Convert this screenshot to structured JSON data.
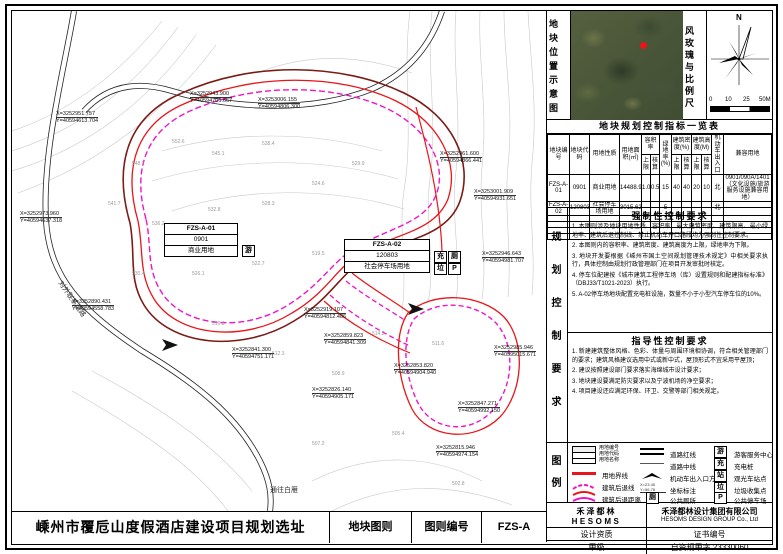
{
  "colors": {
    "boundary_red": "#e8151a",
    "setback_magenta": "#f013c8",
    "ring_maroon": "#7a1b15",
    "contour_gray": "#c9c9c9"
  },
  "titlebar": {
    "project": "嵊州市覆卮山度假酒店建设项目规划选址",
    "sheet_type": "地块图则",
    "sheet_no_label": "图则编号",
    "sheet_no": "FZS-A"
  },
  "panel": {
    "location_label": "地块位置示意图",
    "windrose_label": "风玫瑰与比例尺",
    "north": "N",
    "scale_ticks": [
      "0",
      "10",
      "25",
      "50M"
    ],
    "table": {
      "title": "地块规划控制指标一览表",
      "h1": {
        "plot_no": "地块编号",
        "plot_code": "地块代码",
        "land_use": "用地性质",
        "area": "用地面积(㎡)",
        "far": "容积率",
        "green": "绿地率(%)",
        "density": "建筑密度(%)",
        "height": "建筑高度(M)",
        "entrance": "机动车出入口",
        "compat": "兼容用地"
      },
      "h2": {
        "upper": "上限",
        "check": "核算"
      },
      "rows": [
        [
          "FZS-A-01",
          "0901",
          "商业用地",
          "14488.90",
          "1.0",
          "0.5",
          "15",
          "40",
          "40",
          "20",
          "10",
          "北",
          "0901/090A/1401（文化设施/旅游服务设施兼容用地）"
        ],
        [
          "FZS-A-02",
          "120803",
          "社会停车场用地",
          "3015.62",
          "-",
          "-",
          "5",
          "-",
          "-",
          "-",
          "-",
          "北",
          "-"
        ]
      ]
    },
    "side_label": "规划控制要求",
    "mandatory": {
      "title": "强制性控制要求",
      "items": [
        "1. 本图则涉及地块用地性质、容积率、最大建筑密度、建筑限高、最小绿地率、建筑后退控制线、禁止机动车开口路段均为强制性控制要求。",
        "2. 本图则内的容积率、建筑密度、建筑高度为上限，绿地率为下限。",
        "3. 地块开发要根据《嵊州市国土空间规划管理技术规定》中相关要求执行，具体控制由规划行政管理部门在项目开发审批时核定。",
        "4. 停车位配建按《城市建筑工程停车场（库）设置规则和配建指标标准》（DBJ33/T1021-2023）执行。",
        "5. A-02停车场地块配置充电桩设施，数量不小于小型汽车停车位的10%。"
      ]
    },
    "guiding": {
      "title": "指导性控制要求",
      "items": [
        "1. 新建建筑整体风格、色彩、体量与周围环境相协调，符合相关管理部门的要求；建筑风格建议选用中式或新中式，屋顶形式不宜采用平屋顶；",
        "2. 建议按照建设部门要求落实海绵城市设计要求；",
        "3. 地块建设要满足防灾要求以及宁波机场的净空要求；",
        "4. 项目建设还应满足环保、环卫、交警等部门相关规定。"
      ]
    },
    "legend": {
      "title": "图例",
      "sample_labels": [
        "用地编号",
        "用地代码",
        "用地名称"
      ],
      "col1": [
        "用地界线",
        "建筑后退线",
        "建筑后退距离"
      ],
      "col2": [
        "道路红线",
        "道路中线",
        "机动车出入口方位",
        "坐标标注",
        "公共厕所"
      ],
      "col2_toilet_icon": "厕",
      "coord_sample": "X=23.45 Y=56.78",
      "col3_icons": [
        "游",
        "充",
        "站",
        "垃",
        "P"
      ],
      "col3_labels": [
        "游客服务中心",
        "充电桩",
        "观光车站点",
        "垃圾收集点",
        "公共停车场"
      ]
    },
    "firm": {
      "logo_cn": "禾泽都林",
      "logo_en": "HESOMS",
      "name_cn": "禾泽都林设计集团有限公司",
      "name_en": "HESOMS DESIGN GROUP Co., Ltd",
      "qual_label": "设计资质",
      "cert_label": "证书编号",
      "qual_value": "甲级",
      "cert_value": "自资规甲字 23330060"
    }
  },
  "map": {
    "plots": [
      {
        "code": "FZS-A-01",
        "land_code": "0901",
        "land_use": "商业用地",
        "icons": [
          "游"
        ]
      },
      {
        "code": "FZS-A-02",
        "land_code": "120803",
        "land_use": "社会停车场用地",
        "icons": [
          "充",
          "厕",
          "垃",
          "P"
        ]
      }
    ],
    "road_label": "对外联系道路",
    "road_label2": "通往白雁",
    "coords": [
      {
        "x": 178,
        "y": 80,
        "l1": "X=3252943.900",
        "l2": "Y=40594706.667"
      },
      {
        "x": 44,
        "y": 100,
        "l1": "X=3252951.757",
        "l2": "Y=40594613.704"
      },
      {
        "x": 246,
        "y": 86,
        "l1": "X=3253006.155",
        "l2": "Y=40594806.300"
      },
      {
        "x": 8,
        "y": 200,
        "l1": "X=3252973.960",
        "l2": "Y=40594637.318"
      },
      {
        "x": 60,
        "y": 288,
        "l1": "X=3252890.431",
        "l2": "Y=40594558.783"
      },
      {
        "x": 428,
        "y": 140,
        "l1": "X=3252961.600",
        "l2": "Y=40594866.441"
      },
      {
        "x": 462,
        "y": 178,
        "l1": "X=3253001.909",
        "l2": "Y=40594931.651"
      },
      {
        "x": 470,
        "y": 240,
        "l1": "X=3252946.643",
        "l2": "Y=40594981.707"
      },
      {
        "x": 482,
        "y": 334,
        "l1": "X=3252985.946",
        "l2": "Y=40595015.671"
      },
      {
        "x": 292,
        "y": 296,
        "l1": "X=3252919.107",
        "l2": "Y=40594812.486"
      },
      {
        "x": 312,
        "y": 322,
        "l1": "X=3252859.823",
        "l2": "Y=40594841.309"
      },
      {
        "x": 382,
        "y": 352,
        "l1": "X=3252853.820",
        "l2": "Y=40594904.940"
      },
      {
        "x": 300,
        "y": 376,
        "l1": "X=3252826.140",
        "l2": "Y=40594905.171"
      },
      {
        "x": 446,
        "y": 390,
        "l1": "X=3252847.271",
        "l2": "Y=40594992.150"
      },
      {
        "x": 424,
        "y": 434,
        "l1": "X=3252815.946",
        "l2": "Y=40594974.154"
      },
      {
        "x": 220,
        "y": 336,
        "l1": "X=3252841.300",
        "l2": "Y=40594751.171"
      }
    ],
    "elevations": [
      {
        "x": 120,
        "y": 150,
        "v": "548.2"
      },
      {
        "x": 160,
        "y": 128,
        "v": "552.6"
      },
      {
        "x": 200,
        "y": 140,
        "v": "545.1"
      },
      {
        "x": 250,
        "y": 130,
        "v": "538.4"
      },
      {
        "x": 96,
        "y": 190,
        "v": "541.7"
      },
      {
        "x": 140,
        "y": 210,
        "v": "536.2"
      },
      {
        "x": 196,
        "y": 196,
        "v": "532.8"
      },
      {
        "x": 250,
        "y": 190,
        "v": "528.3"
      },
      {
        "x": 300,
        "y": 170,
        "v": "524.6"
      },
      {
        "x": 340,
        "y": 150,
        "v": "529.9"
      },
      {
        "x": 120,
        "y": 260,
        "v": "530.4"
      },
      {
        "x": 180,
        "y": 260,
        "v": "526.1"
      },
      {
        "x": 240,
        "y": 250,
        "v": "522.7"
      },
      {
        "x": 300,
        "y": 240,
        "v": "519.5"
      },
      {
        "x": 200,
        "y": 310,
        "v": "516.8"
      },
      {
        "x": 260,
        "y": 340,
        "v": "512.3"
      },
      {
        "x": 320,
        "y": 360,
        "v": "508.9"
      },
      {
        "x": 360,
        "y": 320,
        "v": "514.2"
      },
      {
        "x": 420,
        "y": 330,
        "v": "511.6"
      },
      {
        "x": 380,
        "y": 420,
        "v": "505.4"
      },
      {
        "x": 300,
        "y": 430,
        "v": "507.2"
      },
      {
        "x": 440,
        "y": 470,
        "v": "502.8"
      }
    ]
  }
}
